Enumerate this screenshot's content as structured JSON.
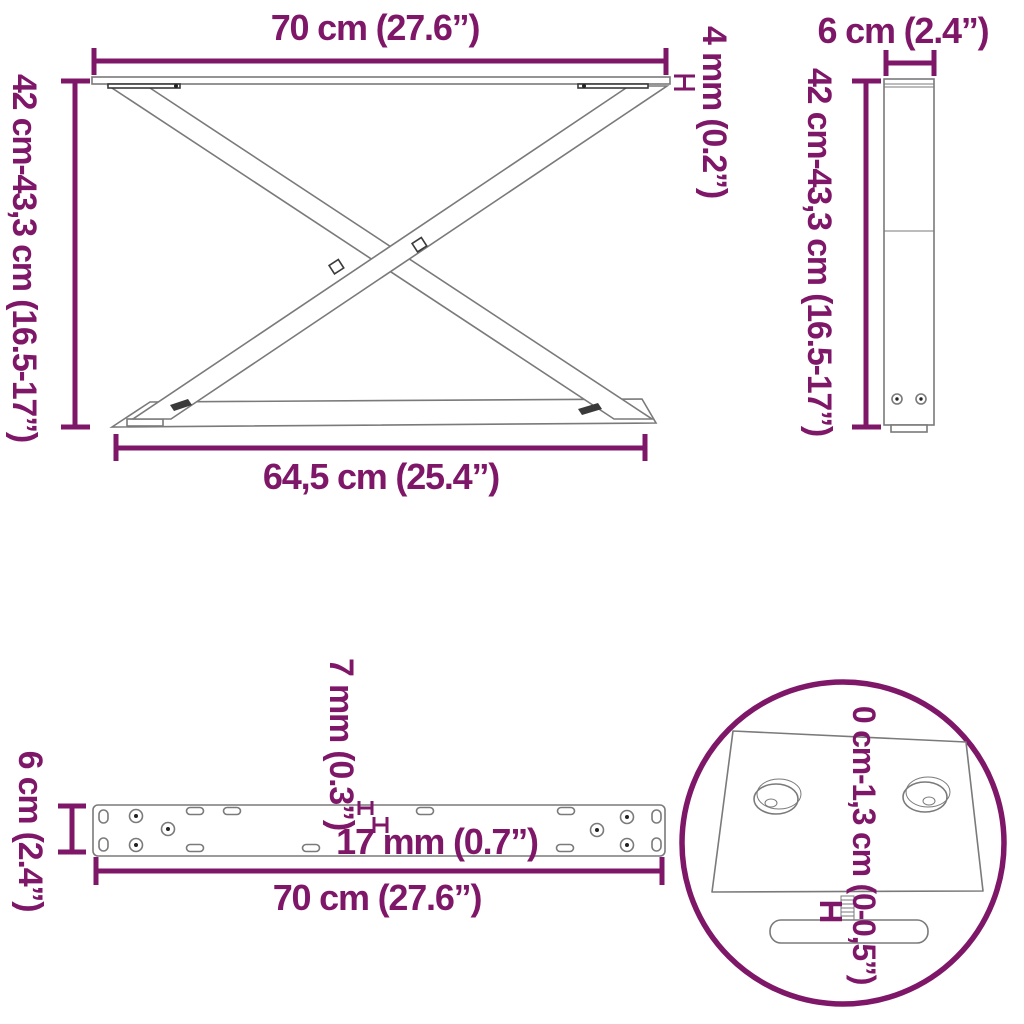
{
  "colors": {
    "accent": "#7f1769",
    "line": "#7a7a7a",
    "dark": "#3a3a3a",
    "background": "#ffffff"
  },
  "diagram": {
    "front_view": {
      "top_width_label": "70 cm (27.6”)",
      "height_label": "42 cm-43,3 cm (16.5-17”)",
      "bottom_width_label": "64,5 cm (25.4”)",
      "plate_thickness_label": "4 mm (0.2”)"
    },
    "side_view": {
      "depth_label": "6 cm (2.4”)",
      "height_label": "42 cm-43,3 cm (16.5-17”)"
    },
    "plate_view": {
      "depth_label": "6 cm (2.4”)",
      "hole_width_label": "7 mm (0.3”)",
      "hole_length_label": "17 mm (0.7”)",
      "length_label": "70 cm (27.6”)"
    },
    "foot_detail": {
      "adjust_range_label": "0 cm-1,3 cm (0-0,5”)"
    }
  }
}
